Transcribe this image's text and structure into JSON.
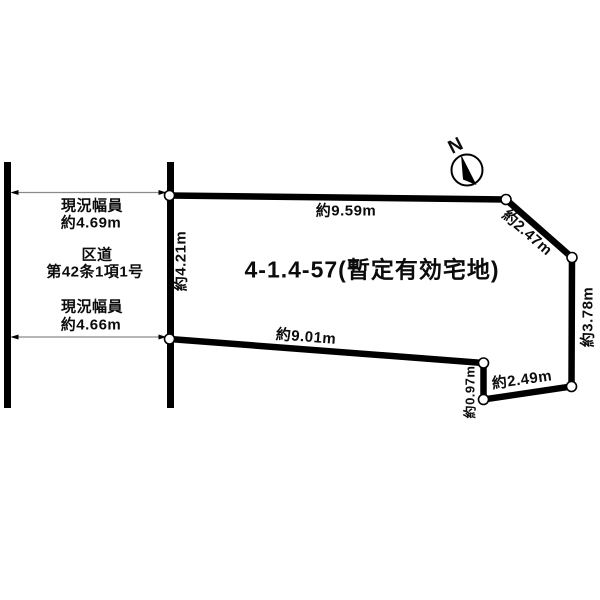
{
  "page": {
    "background": "#ffffff",
    "line_color": "#000000",
    "dim_line_color": "#8a8a8a"
  },
  "title": {
    "text": "4-1.4-57(暫定有効宅地)"
  },
  "north": {
    "label": "N"
  },
  "road": {
    "upper_width_label": [
      "現況幅員",
      "約4.69m"
    ],
    "name_label": [
      "区道",
      "第42条1項1号"
    ],
    "lower_width_label": [
      "現況幅員",
      "約4.66m"
    ]
  },
  "dimensions": {
    "west_edge": "約4.21m",
    "north_edge": "約9.59m",
    "northeast_edge": "約2.47m",
    "east_edge": "約3.78m",
    "southeast_edge": "約2.49m",
    "south_step_edge": "約0.97m",
    "south_edge": "約9.01m"
  }
}
